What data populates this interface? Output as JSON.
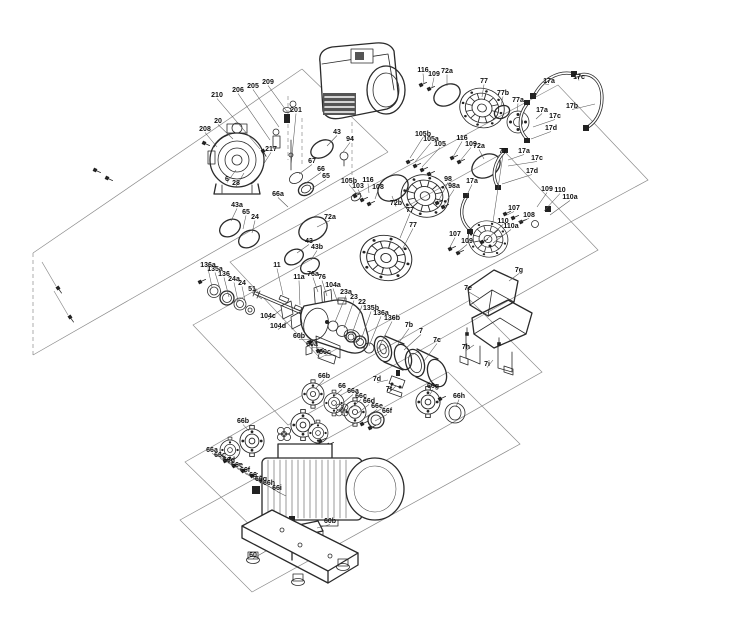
{
  "diagram": {
    "kind": "pump-exploded-parts-diagram",
    "background": "#ffffff",
    "line_color": "#222222",
    "label_color": "#111111",
    "part_labels": [
      {
        "t": "210",
        "x": 217,
        "y": 97,
        "lx": 260,
        "ly": 149
      },
      {
        "t": "206",
        "x": 238,
        "y": 92,
        "lx": 270,
        "ly": 140
      },
      {
        "t": "205",
        "x": 253,
        "y": 88,
        "lx": 279,
        "ly": 127
      },
      {
        "t": "209",
        "x": 268,
        "y": 84,
        "lx": 288,
        "ly": 113
      },
      {
        "t": "201",
        "x": 296,
        "y": 112,
        "lx": 291,
        "ly": 166
      },
      {
        "t": "20",
        "x": 218,
        "y": 123,
        "lx": 233,
        "ly": 139
      },
      {
        "t": "208",
        "x": 205,
        "y": 131,
        "lx": 217,
        "ly": 147
      },
      {
        "t": "217",
        "x": 271,
        "y": 151,
        "lx": 263,
        "ly": 165
      },
      {
        "t": "6",
        "x": 227,
        "y": 181,
        "lx": 236,
        "ly": 170
      },
      {
        "t": "28",
        "x": 236,
        "y": 185,
        "lx": 244,
        "ly": 173
      },
      {
        "t": "43",
        "x": 337,
        "y": 134,
        "lx": 327,
        "ly": 146
      },
      {
        "t": "94",
        "x": 350,
        "y": 141,
        "lx": 343,
        "ly": 152
      },
      {
        "t": "43a",
        "x": 237,
        "y": 207,
        "lx": 231,
        "ly": 221
      },
      {
        "t": "65",
        "x": 246,
        "y": 214,
        "lx": 243,
        "ly": 229
      },
      {
        "t": "24",
        "x": 255,
        "y": 219,
        "lx": 252,
        "ly": 233
      },
      {
        "t": "66a",
        "x": 278,
        "y": 196,
        "lx": 288,
        "ly": 207
      },
      {
        "t": "43",
        "x": 309,
        "y": 243,
        "lx": 297,
        "ly": 253
      },
      {
        "t": "43b",
        "x": 317,
        "y": 249,
        "lx": 311,
        "ly": 260
      },
      {
        "t": "67",
        "x": 312,
        "y": 163,
        "lx": 299,
        "ly": 174
      },
      {
        "t": "66",
        "x": 321,
        "y": 171,
        "lx": 306,
        "ly": 183
      },
      {
        "t": "65",
        "x": 326,
        "y": 178,
        "lx": 311,
        "ly": 189
      },
      {
        "t": "72a",
        "x": 330,
        "y": 219,
        "lx": 317,
        "ly": 227
      },
      {
        "t": "105b",
        "x": 349,
        "y": 183,
        "lx": 356,
        "ly": 193
      },
      {
        "t": "103",
        "x": 358,
        "y": 188,
        "lx": 362,
        "ly": 197
      },
      {
        "t": "116",
        "x": 368,
        "y": 182,
        "lx": 369,
        "ly": 193
      },
      {
        "t": "108",
        "x": 378,
        "y": 189,
        "lx": 375,
        "ly": 199
      },
      {
        "t": "72b",
        "x": 396,
        "y": 205,
        "lx": 392,
        "ly": 196
      },
      {
        "t": "77",
        "x": 410,
        "y": 212,
        "lx": 400,
        "ly": 238
      },
      {
        "t": "77",
        "x": 413,
        "y": 227,
        "lx": 402,
        "ly": 250
      },
      {
        "t": "105b",
        "x": 423,
        "y": 136,
        "lx": 410,
        "ly": 158
      },
      {
        "t": "105a",
        "x": 431,
        "y": 141,
        "lx": 415,
        "ly": 162
      },
      {
        "t": "105",
        "x": 440,
        "y": 146,
        "lx": 422,
        "ly": 167
      },
      {
        "t": "116",
        "x": 462,
        "y": 140,
        "lx": 453,
        "ly": 157
      },
      {
        "t": "109",
        "x": 471,
        "y": 146,
        "lx": 460,
        "ly": 161
      },
      {
        "t": "72a",
        "x": 479,
        "y": 148,
        "lx": 484,
        "ly": 159
      },
      {
        "t": "98",
        "x": 448,
        "y": 181,
        "lx": 439,
        "ly": 200
      },
      {
        "t": "98a",
        "x": 454,
        "y": 188,
        "lx": 444,
        "ly": 205
      },
      {
        "t": "17a",
        "x": 472,
        "y": 183,
        "lx": 467,
        "ly": 195
      },
      {
        "t": "77",
        "x": 503,
        "y": 153,
        "lx": 493,
        "ly": 222
      },
      {
        "t": "107",
        "x": 455,
        "y": 236,
        "lx": 450,
        "ly": 247
      },
      {
        "t": "109",
        "x": 467,
        "y": 243,
        "lx": 458,
        "ly": 252
      },
      {
        "t": "109",
        "x": 547,
        "y": 191,
        "lx": 537,
        "ly": 207
      },
      {
        "t": "110",
        "x": 560,
        "y": 192,
        "lx": 544,
        "ly": 211
      },
      {
        "t": "110a",
        "x": 570,
        "y": 199,
        "lx": 550,
        "ly": 215
      },
      {
        "t": "107",
        "x": 514,
        "y": 210,
        "lx": 507,
        "ly": 215
      },
      {
        "t": "108",
        "x": 529,
        "y": 217,
        "lx": 518,
        "ly": 222
      },
      {
        "t": "110",
        "x": 503,
        "y": 223,
        "lx": 487,
        "ly": 239
      },
      {
        "t": "110a",
        "x": 511,
        "y": 228,
        "lx": 493,
        "ly": 243
      },
      {
        "t": "17a",
        "x": 524,
        "y": 153,
        "lx": 508,
        "ly": 160
      },
      {
        "t": "17c",
        "x": 537,
        "y": 160,
        "lx": 508,
        "ly": 166
      },
      {
        "t": "17d",
        "x": 532,
        "y": 173,
        "lx": 502,
        "ly": 184
      },
      {
        "t": "116",
        "x": 423,
        "y": 72,
        "lx": 424,
        "ly": 84
      },
      {
        "t": "109",
        "x": 434,
        "y": 76,
        "lx": 432,
        "ly": 87
      },
      {
        "t": "72a",
        "x": 447,
        "y": 73,
        "lx": 447,
        "ly": 86
      },
      {
        "t": "77",
        "x": 484,
        "y": 83,
        "lx": 482,
        "ly": 97
      },
      {
        "t": "77b",
        "x": 503,
        "y": 95,
        "lx": 501,
        "ly": 106
      },
      {
        "t": "77a",
        "x": 518,
        "y": 102,
        "lx": 517,
        "ly": 112
      },
      {
        "t": "17a",
        "x": 549,
        "y": 83,
        "lx": 545,
        "ly": 84
      },
      {
        "t": "17c",
        "x": 579,
        "y": 79,
        "lx": 578,
        "ly": 77
      },
      {
        "t": "17b",
        "x": 572,
        "y": 108,
        "lx": 595,
        "ly": 104
      },
      {
        "t": "17a",
        "x": 542,
        "y": 112,
        "lx": 536,
        "ly": 119
      },
      {
        "t": "17c",
        "x": 555,
        "y": 118,
        "lx": 533,
        "ly": 127
      },
      {
        "t": "17d",
        "x": 551,
        "y": 130,
        "lx": 531,
        "ly": 139
      },
      {
        "t": "136a",
        "x": 208,
        "y": 267,
        "lx": 212,
        "ly": 287
      },
      {
        "t": "135a",
        "x": 215,
        "y": 271,
        "lx": 221,
        "ly": 292
      },
      {
        "t": "136",
        "x": 224,
        "y": 276,
        "lx": 229,
        "ly": 297
      },
      {
        "t": "24a",
        "x": 234,
        "y": 281,
        "lx": 238,
        "ly": 301
      },
      {
        "t": "24",
        "x": 242,
        "y": 285,
        "lx": 246,
        "ly": 305
      },
      {
        "t": "51",
        "x": 252,
        "y": 291,
        "lx": 262,
        "ly": 299
      },
      {
        "t": "11",
        "x": 277,
        "y": 267,
        "lx": 283,
        "ly": 295
      },
      {
        "t": "11a",
        "x": 299,
        "y": 279,
        "lx": 300,
        "ly": 305
      },
      {
        "t": "76a",
        "x": 313,
        "y": 276,
        "lx": 318,
        "ly": 292
      },
      {
        "t": "76",
        "x": 322,
        "y": 279,
        "lx": 327,
        "ly": 296
      },
      {
        "t": "104a",
        "x": 333,
        "y": 287,
        "lx": 338,
        "ly": 303
      },
      {
        "t": "23a",
        "x": 346,
        "y": 294,
        "lx": 335,
        "ly": 322
      },
      {
        "t": "23",
        "x": 354,
        "y": 299,
        "lx": 344,
        "ly": 328
      },
      {
        "t": "22",
        "x": 362,
        "y": 304,
        "lx": 352,
        "ly": 334
      },
      {
        "t": "135b",
        "x": 371,
        "y": 310,
        "lx": 361,
        "ly": 340
      },
      {
        "t": "136a",
        "x": 381,
        "y": 315,
        "lx": 369,
        "ly": 346
      },
      {
        "t": "136b",
        "x": 392,
        "y": 320,
        "lx": 377,
        "ly": 351
      },
      {
        "t": "104c",
        "x": 268,
        "y": 318,
        "lx": 282,
        "ly": 309
      },
      {
        "t": "104d",
        "x": 278,
        "y": 328,
        "lx": 291,
        "ly": 320
      },
      {
        "t": "60b",
        "x": 299,
        "y": 338,
        "lx": 315,
        "ly": 340
      },
      {
        "t": "60a",
        "x": 312,
        "y": 346,
        "lx": 323,
        "ly": 348
      },
      {
        "t": "60c",
        "x": 325,
        "y": 354,
        "lx": 333,
        "ly": 355
      },
      {
        "t": "7b",
        "x": 409,
        "y": 327,
        "lx": 398,
        "ly": 344
      },
      {
        "t": "7",
        "x": 421,
        "y": 333,
        "lx": 404,
        "ly": 350
      },
      {
        "t": "7c",
        "x": 437,
        "y": 342,
        "lx": 424,
        "ly": 361
      },
      {
        "t": "7d",
        "x": 377,
        "y": 381,
        "lx": 388,
        "ly": 380
      },
      {
        "t": "7f",
        "x": 389,
        "y": 391,
        "lx": 396,
        "ly": 386
      },
      {
        "t": "7e",
        "x": 468,
        "y": 290,
        "lx": 479,
        "ly": 298
      },
      {
        "t": "7g",
        "x": 519,
        "y": 272,
        "lx": 509,
        "ly": 281
      },
      {
        "t": "7h",
        "x": 466,
        "y": 349,
        "lx": 474,
        "ly": 345
      },
      {
        "t": "7i",
        "x": 487,
        "y": 366,
        "lx": 493,
        "ly": 360
      },
      {
        "t": "66b",
        "x": 324,
        "y": 378,
        "lx": 316,
        "ly": 388
      },
      {
        "t": "66",
        "x": 342,
        "y": 388,
        "lx": 333,
        "ly": 397
      },
      {
        "t": "66a",
        "x": 353,
        "y": 393,
        "lx": 343,
        "ly": 403
      },
      {
        "t": "66c",
        "x": 361,
        "y": 398,
        "lx": 351,
        "ly": 408
      },
      {
        "t": "66d",
        "x": 369,
        "y": 403,
        "lx": 358,
        "ly": 413
      },
      {
        "t": "66e",
        "x": 377,
        "y": 408,
        "lx": 366,
        "ly": 417
      },
      {
        "t": "66f",
        "x": 387,
        "y": 413,
        "lx": 375,
        "ly": 421
      },
      {
        "t": "66g",
        "x": 433,
        "y": 388,
        "lx": 429,
        "ly": 396
      },
      {
        "t": "66h",
        "x": 459,
        "y": 398,
        "lx": 456,
        "ly": 407
      },
      {
        "t": "66b",
        "x": 243,
        "y": 423,
        "lx": 249,
        "ly": 431
      },
      {
        "t": "66a",
        "x": 212,
        "y": 452,
        "lx": 224,
        "ly": 459
      },
      {
        "t": "66c",
        "x": 220,
        "y": 457,
        "lx": 233,
        "ly": 464
      },
      {
        "t": "66d",
        "x": 229,
        "y": 462,
        "lx": 242,
        "ly": 470
      },
      {
        "t": "66e",
        "x": 237,
        "y": 467,
        "lx": 250,
        "ly": 475
      },
      {
        "t": "66f",
        "x": 245,
        "y": 472,
        "lx": 258,
        "ly": 480
      },
      {
        "t": "66",
        "x": 253,
        "y": 477,
        "lx": 265,
        "ly": 484
      },
      {
        "t": "66g",
        "x": 261,
        "y": 481,
        "lx": 272,
        "ly": 488
      },
      {
        "t": "66h",
        "x": 269,
        "y": 485,
        "lx": 280,
        "ly": 493
      },
      {
        "t": "66i",
        "x": 277,
        "y": 490,
        "lx": 286,
        "ly": 496
      },
      {
        "t": "60b",
        "x": 330,
        "y": 523,
        "lx": 317,
        "ly": 528
      },
      {
        "t": "60",
        "x": 253,
        "y": 557,
        "lx": 266,
        "ly": 551
      }
    ]
  }
}
